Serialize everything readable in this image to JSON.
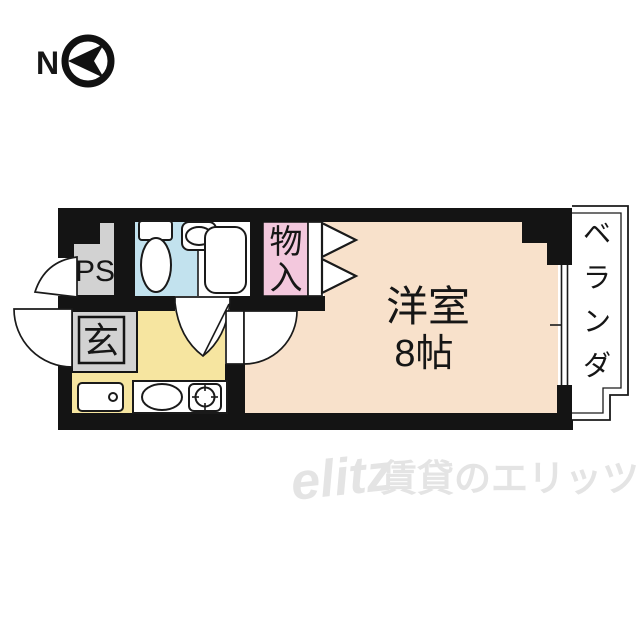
{
  "north_indicator": {
    "label": "N",
    "icon": "compass-arrow-left"
  },
  "plan": {
    "pipe_space": {
      "label": "PS"
    },
    "entrance": {
      "label": "玄"
    },
    "closet": {
      "name": "物入",
      "chars": [
        "物",
        "入"
      ]
    },
    "main_room": {
      "name": "洋室",
      "size": "8帖"
    },
    "balcony": {
      "name": "ベランダ",
      "chars": [
        "ベ",
        "ラ",
        "ン",
        "ダ"
      ]
    },
    "fixtures": [
      "toilet",
      "sink",
      "bathtub",
      "kitchen-sink",
      "stove",
      "washer-space"
    ]
  },
  "watermark": {
    "logo": "elitz",
    "text": "賃貸のエリッツ"
  },
  "colors": {
    "wall": "#141414",
    "room": "#F8E1CB",
    "kitchen": "#F6E5A0",
    "bath": "#C2E2EE",
    "closet": "#F3C8DD",
    "gray": "#D2D2D2",
    "line": "#1a1a1a",
    "watermark": "#E4E4E4"
  }
}
